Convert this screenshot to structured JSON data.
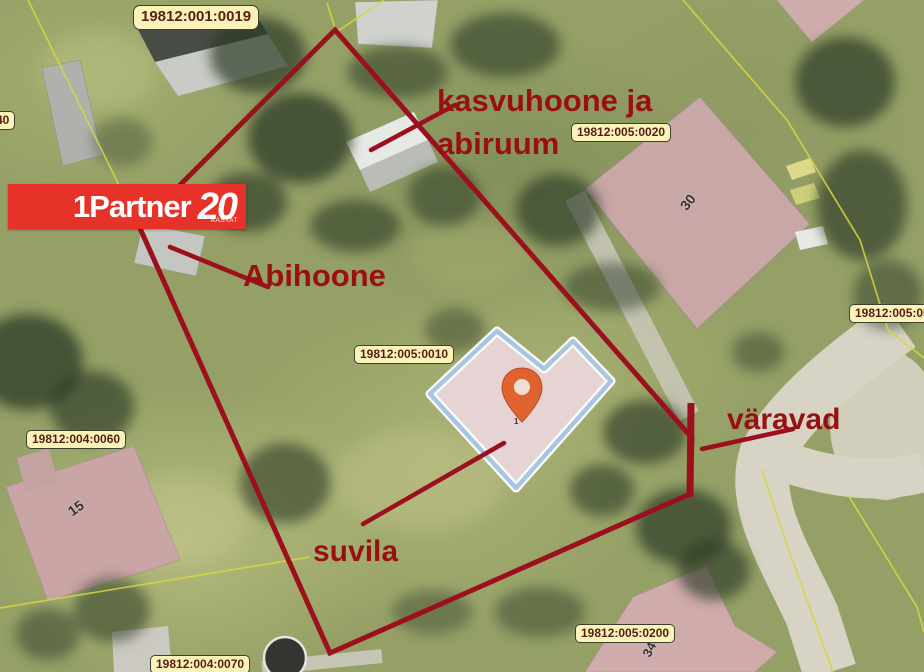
{
  "map_type": "aerial-cadastral-map",
  "logo": {
    "brand": "1Partner",
    "years": "20",
    "subtext": "AASTAT"
  },
  "annotations": {
    "kasvuhoone_line1": "kasvuhoone ja",
    "kasvuhoone_line2": "abiruum",
    "abihoone": "Abihoone",
    "suvila": "suvila",
    "varavad": "väravad"
  },
  "cadastral_labels": {
    "c0019": "19812:001:0019",
    "c0020": "19812:005:0020",
    "c05": "19812:005:05",
    "c0010": "19812:005:0010",
    "c0060": "19812:004:0060",
    "c0070": "19812:004:0070",
    "c0200": "19812:005:0200",
    "c40": "40"
  },
  "house_numbers": {
    "h30": "30",
    "h15": "15",
    "h34": "34",
    "pin_sub": "1"
  },
  "colors": {
    "boundary_red": "#9c101e",
    "annotation_red": "#990f12",
    "cadastral_line_yellow": "#d8d63e",
    "label_bg": "#fbf3ba",
    "label_text": "#581d0d",
    "logo_bg": "#e63228",
    "highlight_outline_blue": "#a7c6e2",
    "highlight_fill_pink": "#e6d4d4",
    "building_roof_pink": "#c9a7a7",
    "pin_orange": "#e0622e",
    "road_gray": "#d7d3c5"
  }
}
